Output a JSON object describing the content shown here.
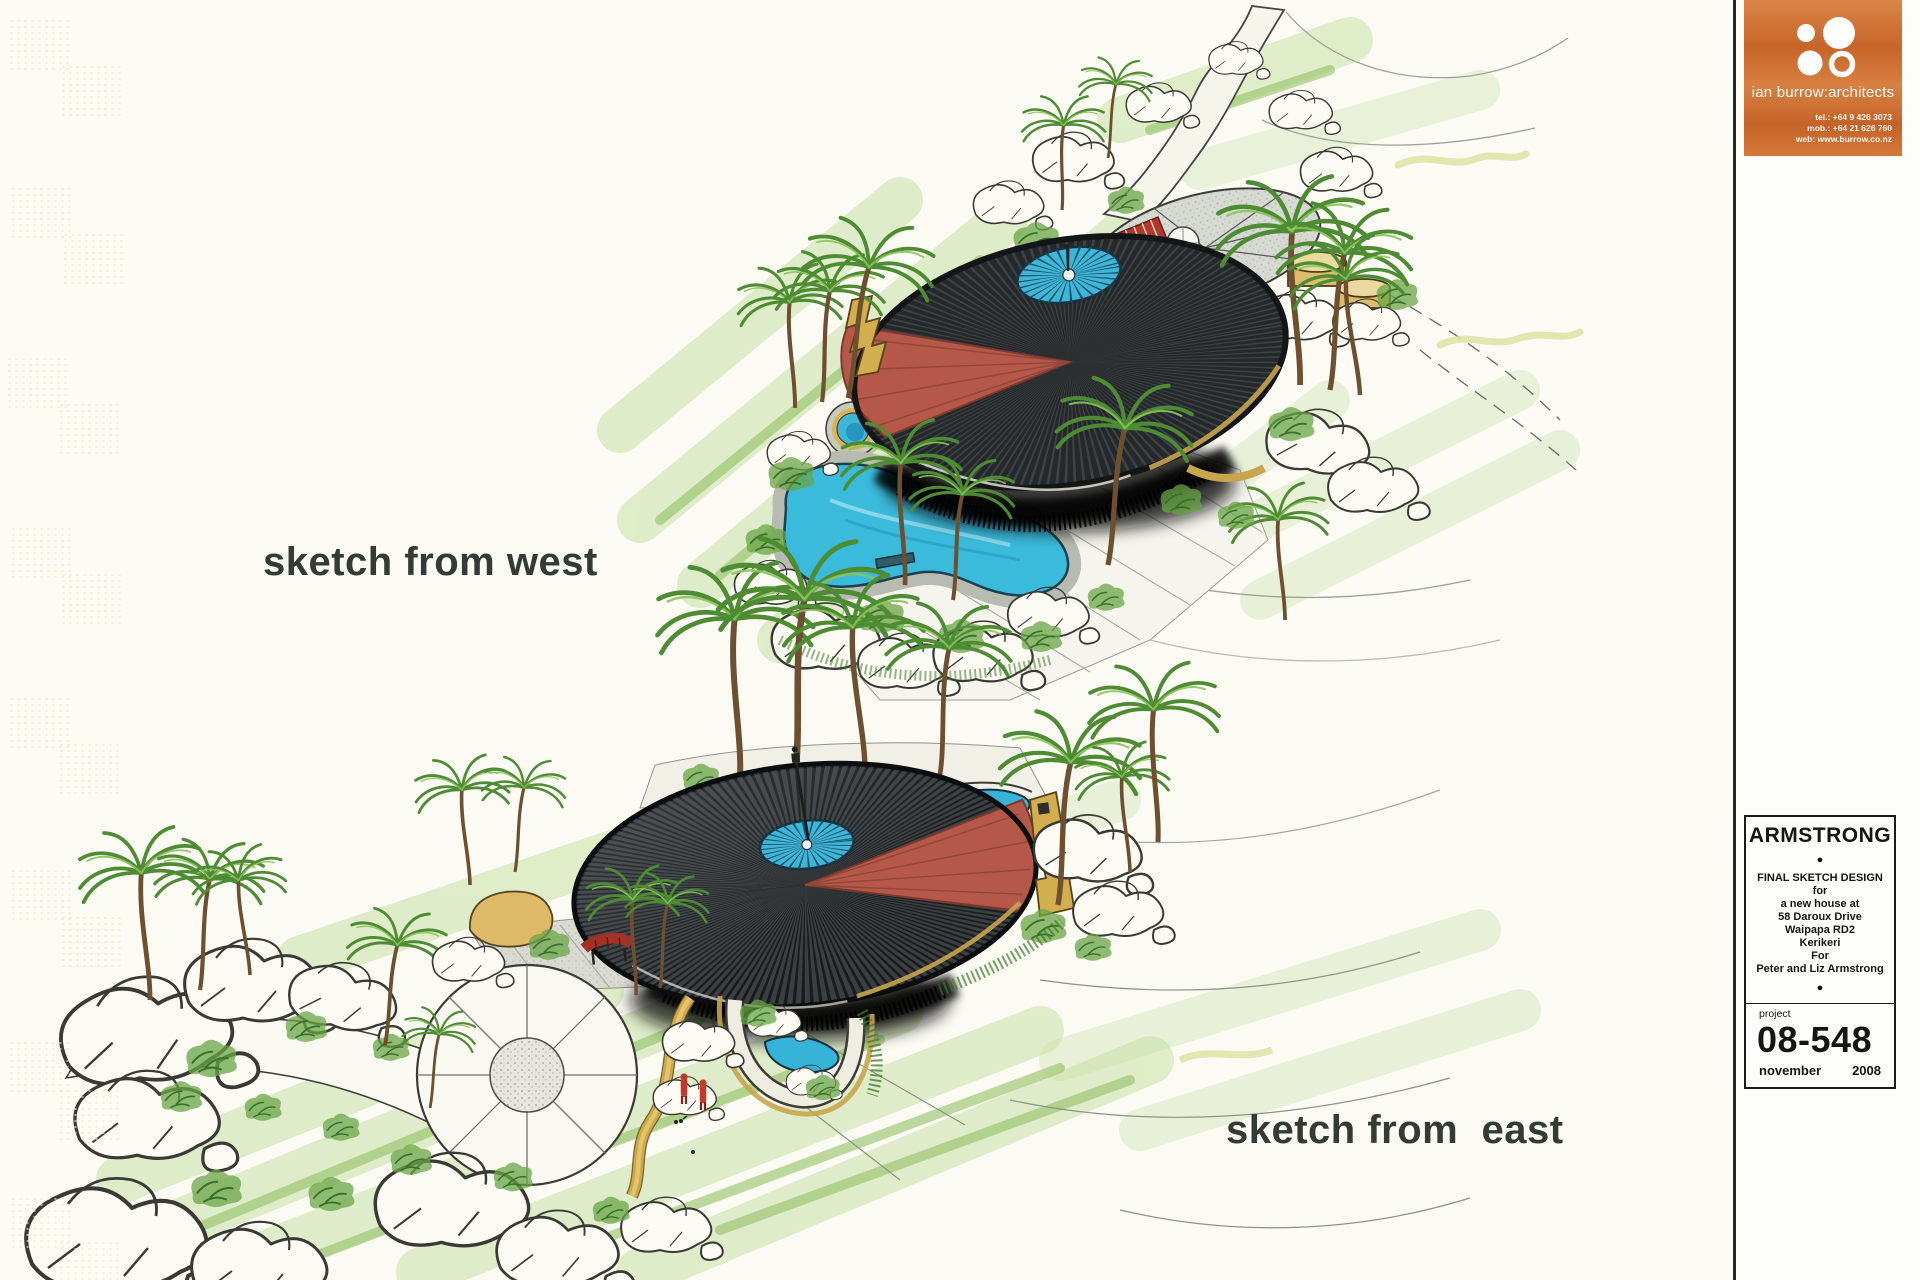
{
  "labels": {
    "west": "sketch from west",
    "east": "sketch from  east"
  },
  "logo_card": {
    "brand": "ian burrow:architects",
    "tel": "tel.: +64 9 426 3073",
    "mob": "mob.: +64 21 626 760",
    "web": "web: www.burrow.co.nz"
  },
  "title_block": {
    "client": "ARMSTRONG",
    "bullet": "●",
    "lines": [
      "FINAL SKETCH DESIGN",
      "for",
      "a new house at",
      "58 Daroux Drive",
      "Waipapa RD2",
      "Kerikeri",
      "For",
      "Peter and Liz Armstrong"
    ],
    "project_label": "project",
    "project_number": "08-548",
    "month": "november",
    "year": "2008"
  },
  "palette": {
    "paper": "#fbfaf3",
    "ink": "#343b35",
    "accent": "#cc6c2d",
    "roof": "#26282a",
    "roof_red": "#b5584a",
    "water": "#3cbcdc",
    "coping": "#d6b44e",
    "grass": "#a9cf79"
  }
}
